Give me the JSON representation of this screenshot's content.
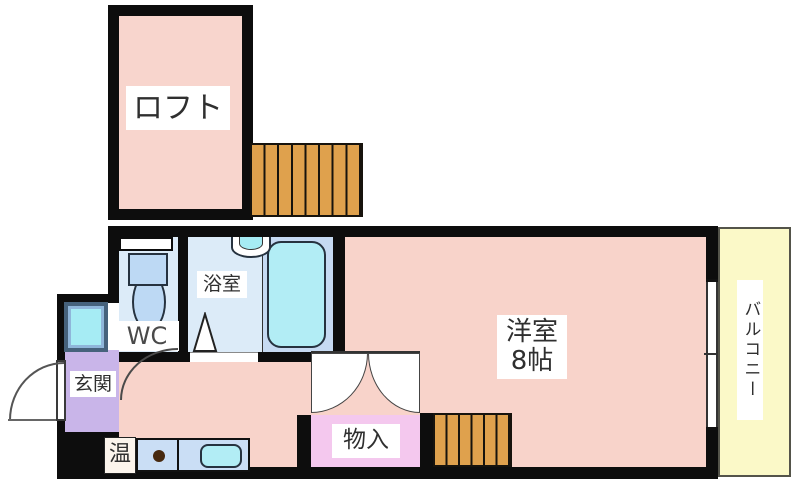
{
  "plan": {
    "type": "apartment-floor-plan",
    "rooms": {
      "loft": {
        "label": "ロフト"
      },
      "western": {
        "name": "洋室",
        "size": "8帖"
      },
      "bathroom": {
        "label": "浴室"
      },
      "wc": {
        "label": "WC"
      },
      "genkan": {
        "label": "玄関"
      },
      "closet": {
        "label": "物入"
      },
      "water_heater": {
        "label": "温"
      },
      "balcony": {
        "label": "バルコニー"
      }
    },
    "palette": {
      "wall": "#0d0d0d",
      "room_pink": "#f8d3ca",
      "wet_room_blue": "#dcebf8",
      "bathtub_cyan": "#b2edf5",
      "stairs_orange": "#dfa14d",
      "genkan_purple": "#c9b5e9",
      "closet_pink": "#f4c8ee",
      "balcony_yellow": "#fbf9c8",
      "kitchen_counter_blue": "#cadef5",
      "washer_cyan": "#a6ecf4"
    }
  }
}
